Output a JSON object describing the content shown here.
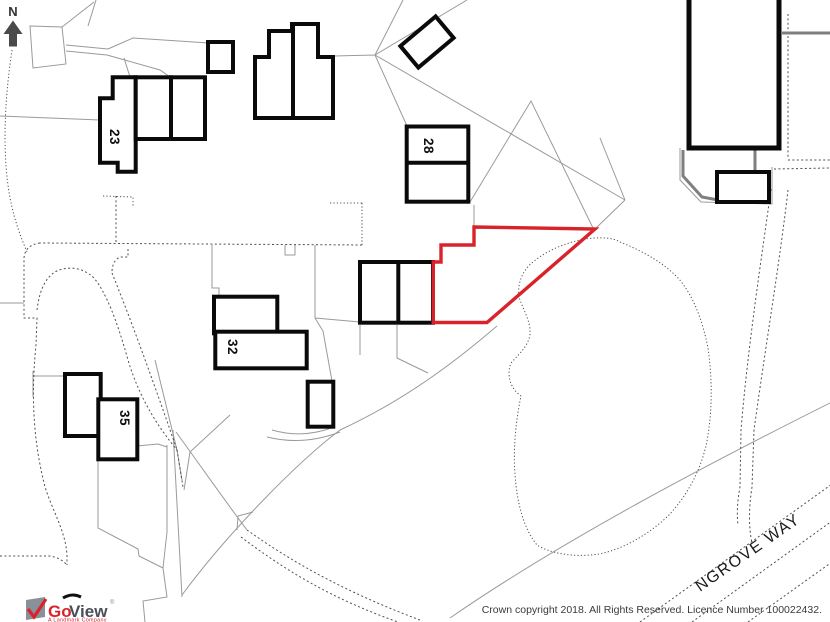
{
  "map": {
    "north_label": "N",
    "buildings": {
      "b23": "23",
      "b28": "28",
      "b32": "32",
      "b35": "35"
    },
    "street_label": "NGROVE WAY",
    "plot_color": "#d8232a",
    "footer": {
      "copyright": "Crown copyright 2018. All Rights Reserved. Licence Number 100022432."
    },
    "logo": {
      "brand_go": "Go",
      "brand_view": "View",
      "registered_mark": "®",
      "tagline": "A Landmark Company"
    }
  }
}
